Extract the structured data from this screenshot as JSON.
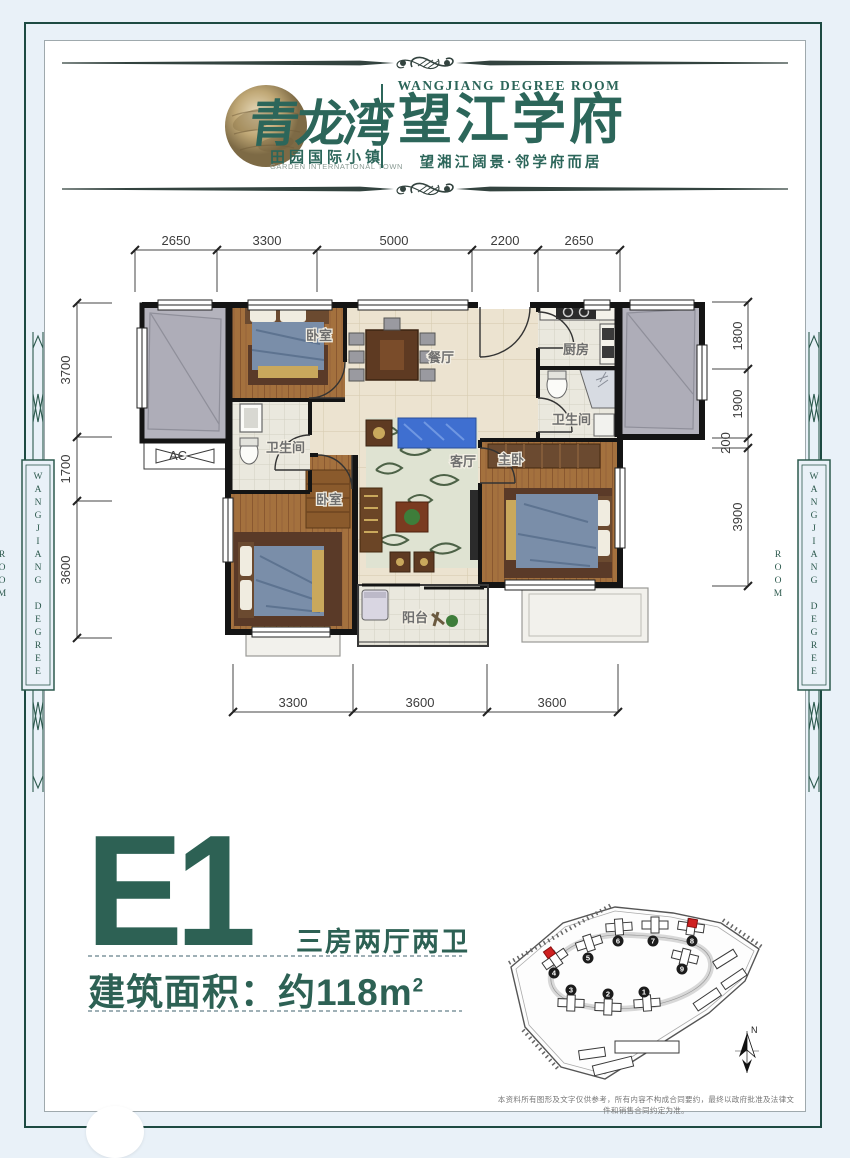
{
  "header": {
    "logo_text": "青龙湾",
    "logo_sub_cn": "田园国际小镇",
    "logo_sub_en": "GARDEN INTERNATIONAL TOWN",
    "project_en": "WANGJIANG DEGREE ROOM",
    "project_cn": "望江学府",
    "tagline": "望湘江阔景·邻学府而居"
  },
  "side_banners": {
    "left": "WANGJIANG DEGREE ROOM",
    "right": "WANGJIANG DEGREE ROOM"
  },
  "floor_plan": {
    "room_labels": {
      "bedroom_top": "卧室",
      "dining_room": "餐厅",
      "kitchen": "厨房",
      "bathroom_right": "卫生间",
      "bathroom_left": "卫生间",
      "living_room": "客厅",
      "master_bedroom": "主卧",
      "bedroom_bottom": "卧室",
      "balcony": "阳台",
      "ac_unit": "AC"
    },
    "dimensions": {
      "top": [
        "2650",
        "3300",
        "5000",
        "2200",
        "2650"
      ],
      "left": [
        "3700",
        "1700",
        "3600"
      ],
      "right": [
        "1800",
        "1900",
        "200",
        "3900"
      ],
      "bottom": [
        "3300",
        "3600",
        "3600"
      ]
    }
  },
  "unit_info": {
    "unit_code": "E1",
    "unit_layout": "三房两厅两卫",
    "area_prefix": "建筑面积：约118m",
    "area_sup": "2"
  },
  "site_plan": {
    "building_numbers": [
      "1",
      "2",
      "3",
      "4",
      "5",
      "6",
      "7",
      "8",
      "9"
    ],
    "compass_label": "N"
  },
  "disclaimer": "本资料所有图形及文字仅供参考，所有内容不构成合同要约，最终以政府批准及法律文件和销售合同约定为准。"
}
